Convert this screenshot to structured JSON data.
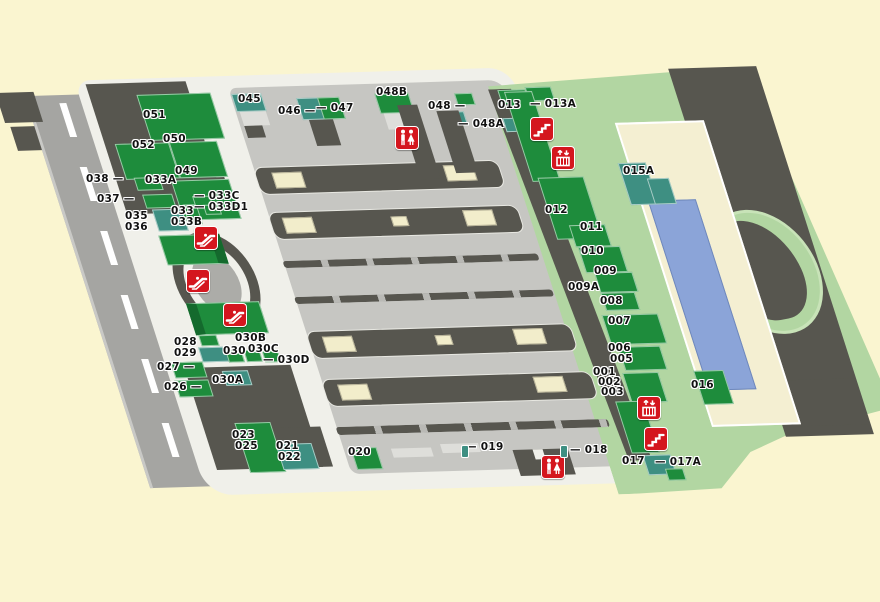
{
  "map": {
    "title": "station-floor-map",
    "colors": {
      "background": "#FAF5D0",
      "east_lawn": "#B2D6A2",
      "shop_green": "#1E8C3C",
      "shop_teal": "#3E8F82",
      "building_dark": "#57564F",
      "station_floor": "#C6C6C2",
      "walkway_white": "#F0F0EA",
      "road_gray": "#A5A5A2",
      "path_cream": "#F4EFD2",
      "water_blue": "#8BA4D8",
      "facility_red": "#D4161E"
    },
    "labels": [
      {
        "text": "051",
        "x": 143,
        "y": 110
      },
      {
        "text": "052",
        "x": 132,
        "y": 140
      },
      {
        "text": "050",
        "x": 163,
        "y": 134
      },
      {
        "text": "049",
        "x": 175,
        "y": 166
      },
      {
        "text": "038 —",
        "x": 86,
        "y": 174
      },
      {
        "text": "037 —",
        "x": 97,
        "y": 194
      },
      {
        "text": "033A",
        "x": 145,
        "y": 175
      },
      {
        "text": "— 033C",
        "x": 194,
        "y": 191
      },
      {
        "text": "— 033D1",
        "x": 194,
        "y": 202
      },
      {
        "text": "035",
        "x": 125,
        "y": 211
      },
      {
        "text": "036",
        "x": 125,
        "y": 222
      },
      {
        "text": "033",
        "x": 171,
        "y": 206
      },
      {
        "text": "033B",
        "x": 171,
        "y": 217
      },
      {
        "text": "045",
        "x": 238,
        "y": 94
      },
      {
        "text": "046 —",
        "x": 278,
        "y": 106
      },
      {
        "text": "— 047",
        "x": 316,
        "y": 103
      },
      {
        "text": "048B",
        "x": 376,
        "y": 87
      },
      {
        "text": "048 —",
        "x": 428,
        "y": 101
      },
      {
        "text": "— 048A",
        "x": 458,
        "y": 119
      },
      {
        "text": "013",
        "x": 498,
        "y": 100
      },
      {
        "text": "— 013A",
        "x": 530,
        "y": 99
      },
      {
        "text": "015A",
        "x": 623,
        "y": 166
      },
      {
        "text": "012",
        "x": 545,
        "y": 205
      },
      {
        "text": "011",
        "x": 580,
        "y": 222
      },
      {
        "text": "010",
        "x": 581,
        "y": 246
      },
      {
        "text": "009",
        "x": 594,
        "y": 266
      },
      {
        "text": "009A",
        "x": 568,
        "y": 282
      },
      {
        "text": "008",
        "x": 600,
        "y": 296
      },
      {
        "text": "007",
        "x": 608,
        "y": 316
      },
      {
        "text": "006",
        "x": 608,
        "y": 343
      },
      {
        "text": "005",
        "x": 610,
        "y": 354
      },
      {
        "text": "001",
        "x": 593,
        "y": 367
      },
      {
        "text": "002",
        "x": 598,
        "y": 377
      },
      {
        "text": "003",
        "x": 601,
        "y": 387
      },
      {
        "text": "016",
        "x": 691,
        "y": 380
      },
      {
        "text": "017",
        "x": 622,
        "y": 456
      },
      {
        "text": "— 017A",
        "x": 655,
        "y": 457
      },
      {
        "text": "— 018",
        "x": 570,
        "y": 445
      },
      {
        "text": "— 019",
        "x": 466,
        "y": 442
      },
      {
        "text": "020",
        "x": 348,
        "y": 447
      },
      {
        "text": "021",
        "x": 276,
        "y": 441
      },
      {
        "text": "022",
        "x": 278,
        "y": 452
      },
      {
        "text": "023",
        "x": 232,
        "y": 430
      },
      {
        "text": "025",
        "x": 235,
        "y": 441
      },
      {
        "text": "026 —",
        "x": 164,
        "y": 382
      },
      {
        "text": "027 —",
        "x": 157,
        "y": 362
      },
      {
        "text": "028",
        "x": 174,
        "y": 337
      },
      {
        "text": "029",
        "x": 174,
        "y": 348
      },
      {
        "text": "030",
        "x": 223,
        "y": 346
      },
      {
        "text": "030B",
        "x": 235,
        "y": 333
      },
      {
        "text": "030C",
        "x": 248,
        "y": 344
      },
      {
        "text": "— 030D",
        "x": 263,
        "y": 355
      },
      {
        "text": "030A",
        "x": 212,
        "y": 375
      }
    ],
    "icons": [
      {
        "type": "restroom",
        "x": 395,
        "y": 126
      },
      {
        "type": "stairs",
        "x": 530,
        "y": 117
      },
      {
        "type": "elevator",
        "x": 551,
        "y": 146
      },
      {
        "type": "escalator",
        "x": 194,
        "y": 226
      },
      {
        "type": "escalator",
        "x": 186,
        "y": 269
      },
      {
        "type": "escalator",
        "x": 223,
        "y": 303
      },
      {
        "type": "elevator",
        "x": 637,
        "y": 396
      },
      {
        "type": "stairs",
        "x": 644,
        "y": 427
      },
      {
        "type": "restroom",
        "x": 541,
        "y": 455
      },
      {
        "type": "spot",
        "x": 461,
        "y": 445
      },
      {
        "type": "spot",
        "x": 560,
        "y": 445
      }
    ]
  }
}
